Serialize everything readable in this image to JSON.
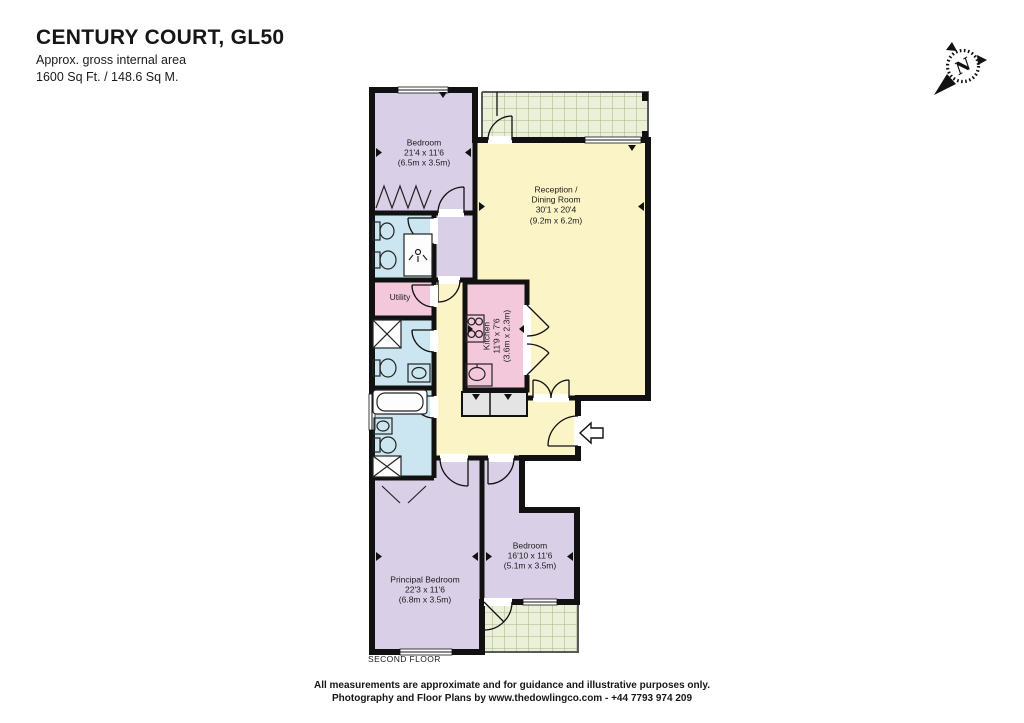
{
  "header": {
    "title": "CENTURY COURT, GL50",
    "subtitle": "Approx. gross internal area",
    "area": "1600 Sq Ft. / 148.6 Sq M."
  },
  "compass": {
    "north_label": "N"
  },
  "floor_plan": {
    "floor_label": "SECOND FLOOR",
    "rooms": {
      "bedroom_top": {
        "name": "Bedroom",
        "dims_imperial": "21'4 x 11'6",
        "dims_metric": "(6.5m x 3.5m)"
      },
      "reception": {
        "name_line1": "Reception /",
        "name_line2": "Dining Room",
        "dims_imperial": "30'1 x 20'4",
        "dims_metric": "(9.2m x 6.2m)"
      },
      "utility": {
        "name": "Utility"
      },
      "kitchen": {
        "name": "Kitchen",
        "dims_imperial": "11'9 x 7'6",
        "dims_metric": "(3.6m x 2.3m)"
      },
      "principal_bedroom": {
        "name": "Principal Bedroom",
        "dims_imperial": "22'3 x 11'6",
        "dims_metric": "(6.8m x 3.5m)"
      },
      "bedroom_2": {
        "name": "Bedroom",
        "dims_imperial": "16'10 x 11'6",
        "dims_metric": "(5.1m x 3.5m)"
      }
    },
    "colors": {
      "bedroom_fill": "#d9cfe7",
      "living_fill": "#fbf4c6",
      "kitchen_fill": "#f3c8da",
      "bathroom_fill": "#cbe6f0",
      "balcony_fill": "#ebf1d9",
      "cupboard_fill": "#e4e4e4",
      "wall": "#111111"
    }
  },
  "footer": {
    "line1": "All measurements are approximate and for guidance and illustrative purposes only.",
    "line2": "Photography and Floor Plans by www.thedowlingco.com - +44 7793 974 209"
  }
}
